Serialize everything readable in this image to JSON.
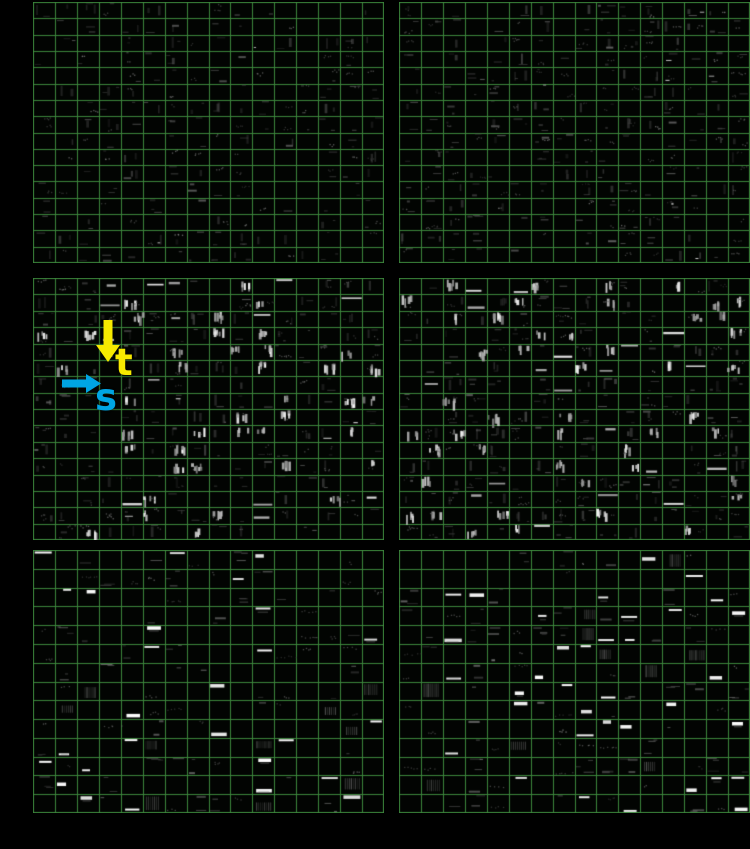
{
  "figure": {
    "background": "#000000",
    "panel_bg": "#020402",
    "grid_color": "#3c873c",
    "content_tone": "grayscale",
    "annotations": {
      "time_label": "t",
      "time_color": "#f7ea00",
      "spectral_label": "s",
      "spectral_color": "#00a5e3"
    },
    "panels": [
      {
        "id": "top-left",
        "x": 33,
        "y": 2,
        "w": 351,
        "h": 261,
        "cols": 16,
        "rows": 16,
        "style": "sparse",
        "seed": 101,
        "activity": 0.5,
        "bright_p": 0.04
      },
      {
        "id": "top-right",
        "x": 399,
        "y": 2,
        "w": 351,
        "h": 261,
        "cols": 16,
        "rows": 16,
        "style": "sparse",
        "seed": 209,
        "activity": 0.62,
        "bright_p": 0.05
      },
      {
        "id": "middle-left",
        "x": 33,
        "y": 278,
        "w": 351,
        "h": 262,
        "cols": 16,
        "rows": 16,
        "style": "streaks",
        "seed": 317,
        "activity": 0.72,
        "bright_p": 0.16
      },
      {
        "id": "middle-right",
        "x": 399,
        "y": 278,
        "w": 351,
        "h": 262,
        "cols": 16,
        "rows": 16,
        "style": "streaks",
        "seed": 423,
        "activity": 0.76,
        "bright_p": 0.18
      },
      {
        "id": "bottom-left",
        "x": 33,
        "y": 550,
        "w": 351,
        "h": 263,
        "cols": 16,
        "rows": 14,
        "style": "tones",
        "seed": 531,
        "activity": 0.55,
        "bright_p": 0.11
      },
      {
        "id": "bottom-right",
        "x": 399,
        "y": 550,
        "w": 351,
        "h": 263,
        "cols": 16,
        "rows": 14,
        "style": "tones",
        "seed": 647,
        "activity": 0.62,
        "bright_p": 0.15
      }
    ]
  }
}
